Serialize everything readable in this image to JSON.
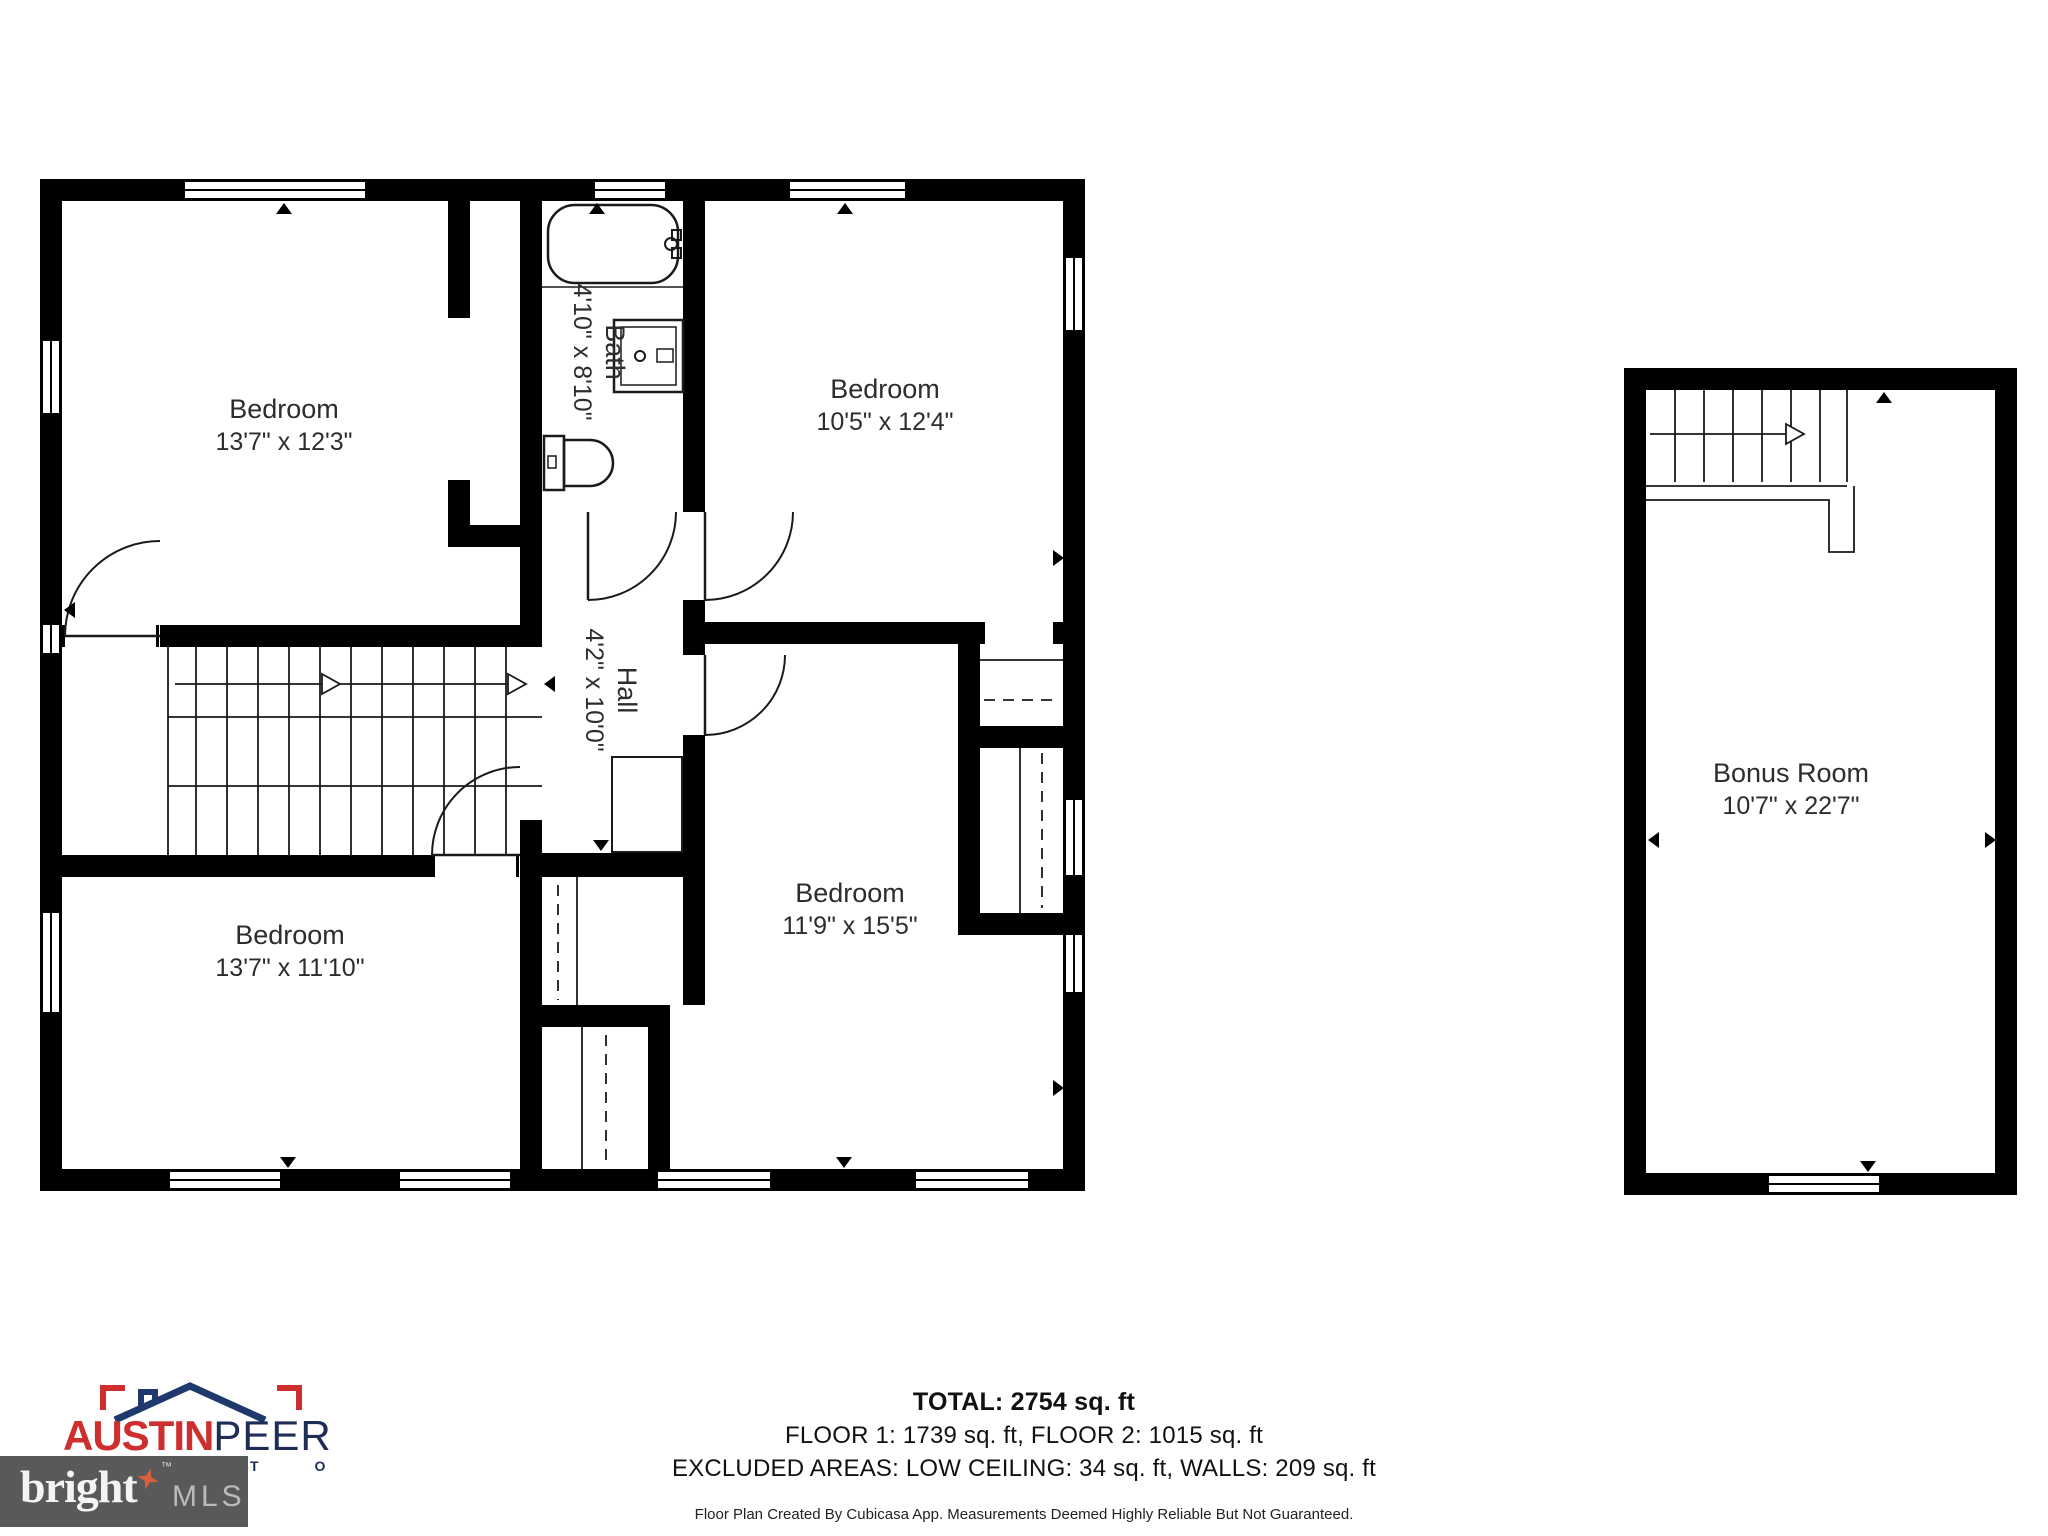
{
  "floorplan": {
    "rooms": [
      {
        "name": "Bedroom",
        "dims": "13'7\" x 12'3\""
      },
      {
        "name": "Bedroom",
        "dims": "10'5\" x 12'4\""
      },
      {
        "name": "Bath",
        "dims": "4'10\" x 8'10\""
      },
      {
        "name": "Hall",
        "dims": "4'2\" x 10'0\""
      },
      {
        "name": "Bedroom",
        "dims": "13'7\" x 11'10\""
      },
      {
        "name": "Bedroom",
        "dims": "11'9\" x 15'5\""
      },
      {
        "name": "Bonus Room",
        "dims": "10'7\" x 22'7\""
      }
    ]
  },
  "summary": {
    "total": "TOTAL: 2754 sq. ft",
    "floors": "FLOOR 1: 1739 sq. ft, FLOOR 2: 1015 sq. ft",
    "excluded": "EXCLUDED AREAS: LOW CEILING: 34 sq. ft, WALLS: 209 sq. ft",
    "disclaimer": "Floor Plan Created By Cubicasa App. Measurements Deemed Highly Reliable But Not Guaranteed."
  },
  "branding": {
    "austin": "AUSTIN",
    "peer": "PEER",
    "partial_letters": "T O",
    "bright": "bright",
    "mls": "MLS",
    "trademark": "™",
    "colors": {
      "brand_red": "#cf2e2e",
      "brand_navy": "#1e2d58",
      "bright_box_gray": "#58595b",
      "star_orange": "#d96038",
      "mls_gray": "#b9babc"
    }
  }
}
